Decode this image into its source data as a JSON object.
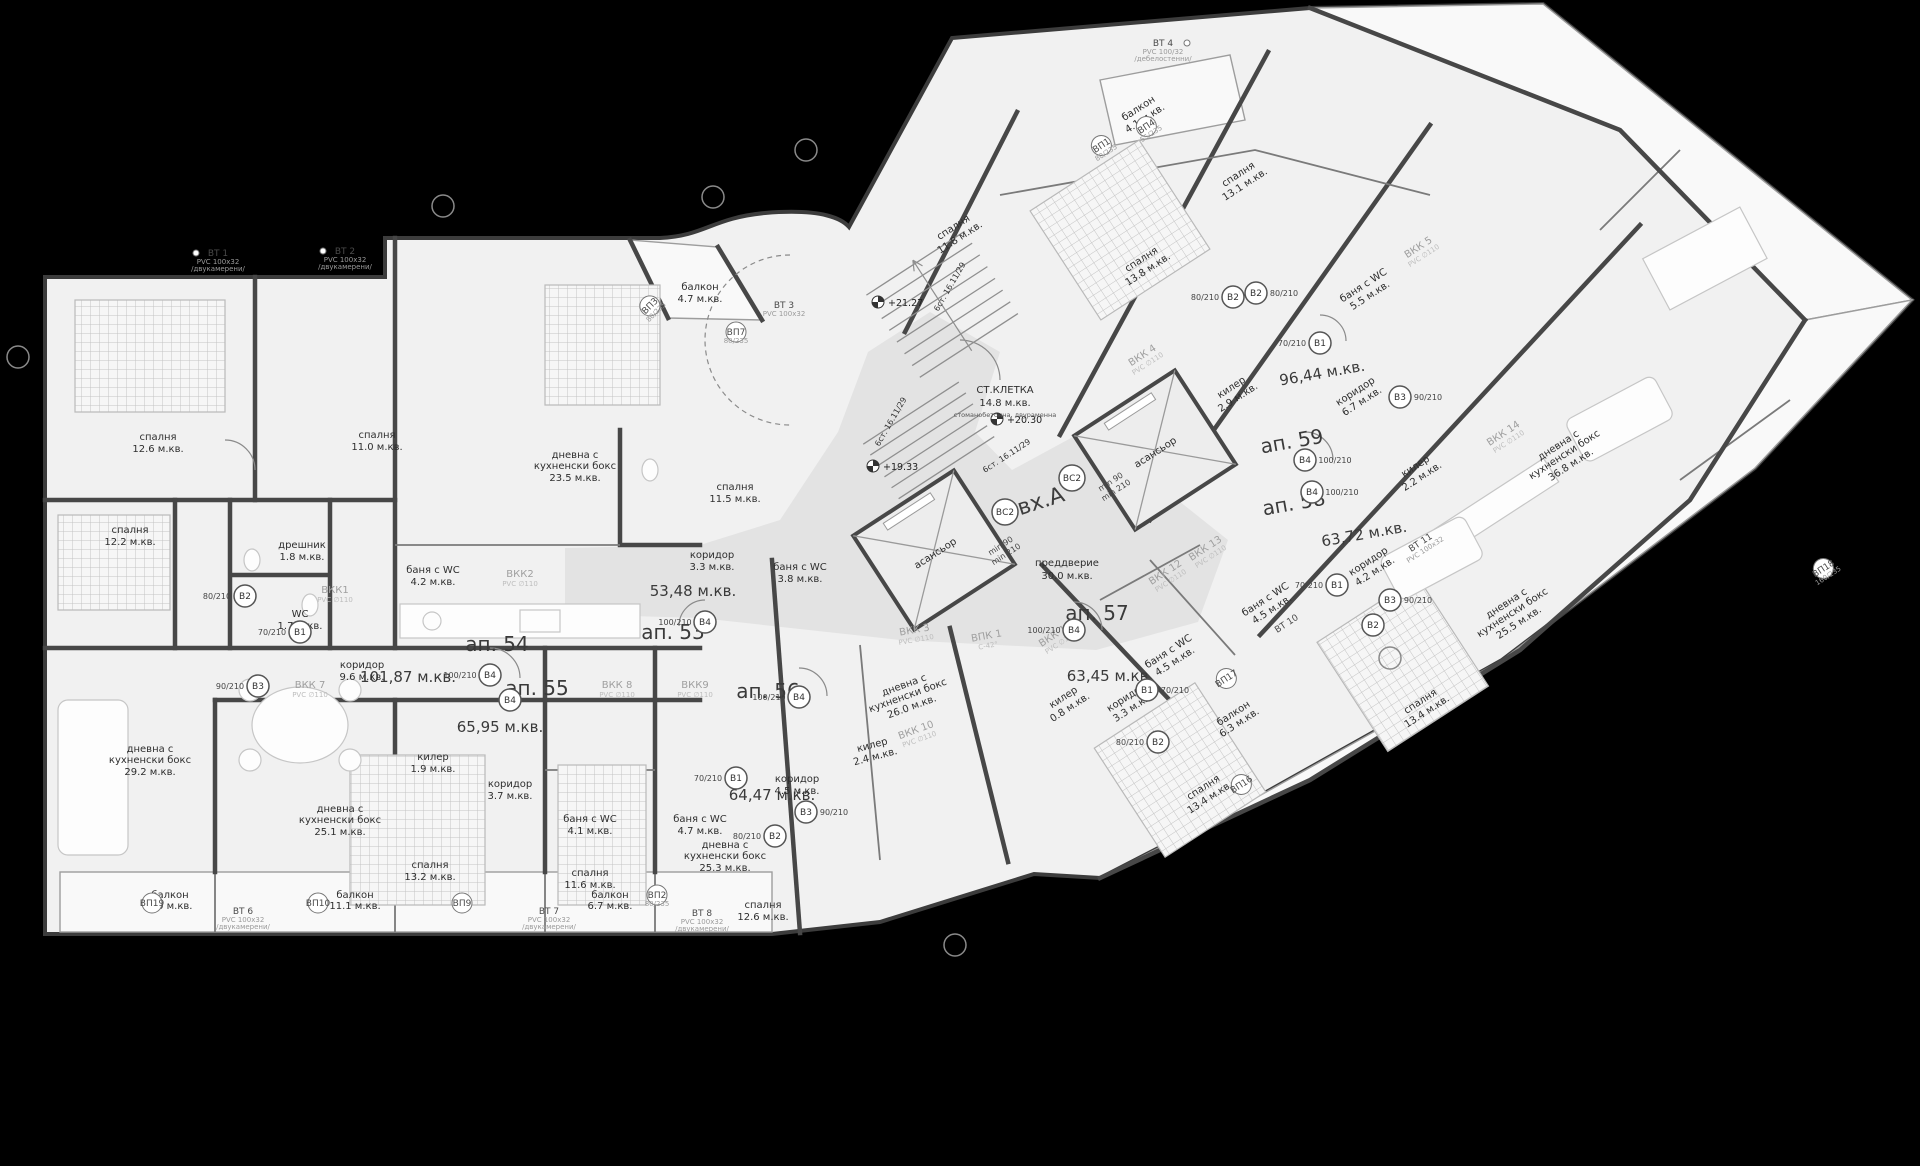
{
  "entrance": {
    "label": "вх.А"
  },
  "core": {
    "stair_name": "СТ.КЛЕТКА",
    "stair_area": "14.8 м.кв.",
    "stair_note": "стоманобетонна, двураменна",
    "flight_note": "6ст. 16.11/29",
    "elev1": "+21.27",
    "elev2": "+20.30",
    "elev3": "+19.33",
    "elevator": "асансьор",
    "vestibule_name": "преддверие",
    "vestibule_area": "30.0 м.кв.",
    "clearance1": "min 90",
    "clearance2": "min 210"
  },
  "apartments": [
    {
      "id": "ап. 53",
      "area": "53,48 м.кв."
    },
    {
      "id": "ап. 54",
      "area": "101,87 м.кв."
    },
    {
      "id": "ап. 55",
      "area": "65,95 м.кв."
    },
    {
      "id": "ап. 56",
      "area": "64,47 м.кв."
    },
    {
      "id": "ап. 57",
      "area": "63,45 м.кв."
    },
    {
      "id": "ап. 58",
      "area": "63,72 м.кв."
    },
    {
      "id": "ап. 59",
      "area": "96,44 м.кв."
    }
  ],
  "rooms": [
    {
      "l1": "спалня",
      "a": "12.6 м.кв."
    },
    {
      "l1": "спалня",
      "a": "11.0 м.кв."
    },
    {
      "l1": "спалня",
      "a": "12.2 м.кв."
    },
    {
      "l1": "дрешник",
      "a": "1.8 м.кв."
    },
    {
      "l1": "WC",
      "a": "1.7 м.кв."
    },
    {
      "l1": "баня с WC",
      "a": "4.2 м.кв."
    },
    {
      "l1": "дневна с",
      "l2": "кухненски бокс",
      "a": "23.5 м.кв."
    },
    {
      "l1": "спалня",
      "a": "11.5 м.кв."
    },
    {
      "l1": "коридор",
      "a": "3.3 м.кв."
    },
    {
      "l1": "баня с WC",
      "a": "3.8 м.кв."
    },
    {
      "l1": "балкон",
      "a": "4.7 м.кв."
    },
    {
      "l1": "коридор",
      "a": "9.6 м.кв."
    },
    {
      "l1": "дневна с",
      "l2": "кухненски бокс",
      "a": "29.2 м.кв."
    },
    {
      "l1": "килер",
      "a": "1.9 м.кв."
    },
    {
      "l1": "коридор",
      "a": "3.7 м.кв."
    },
    {
      "l1": "дневна с",
      "l2": "кухненски бокс",
      "a": "25.1 м.кв."
    },
    {
      "l1": "баня с WC",
      "a": "4.1 м.кв."
    },
    {
      "l1": "спалня",
      "a": "13.2 м.кв."
    },
    {
      "l1": "баня с WC",
      "a": "4.7 м.кв."
    },
    {
      "l1": "коридор",
      "a": "4.5 м.кв."
    },
    {
      "l1": "спалня",
      "a": "11.6 м.кв."
    },
    {
      "l1": "спалня",
      "a": "12.6 м.кв."
    },
    {
      "l1": "дневна с",
      "l2": "кухненски бокс",
      "a": "25.3 м.кв."
    },
    {
      "l1": "килер",
      "a": "2.4 м.кв."
    },
    {
      "l1": "дневна с",
      "l2": "кухненски бокс",
      "a": "26.0 м.кв."
    },
    {
      "l1": "спалня",
      "a": "11.8 м.кв."
    },
    {
      "l1": "спалня",
      "a": "13.8 м.кв."
    },
    {
      "l1": "спалня",
      "a": "13.1 м.кв."
    },
    {
      "l1": "баня с WC",
      "a": "5.5 м.кв."
    },
    {
      "l1": "килер",
      "a": "2.9 м.кв."
    },
    {
      "l1": "коридор",
      "a": "6.7 м.кв."
    },
    {
      "l1": "балкон",
      "a": "4.1 м.кв."
    },
    {
      "l1": "дневна с",
      "l2": "кухненски бокс",
      "a": "36.8 м.кв."
    },
    {
      "l1": "коридор",
      "a": "4.2 м.кв."
    },
    {
      "l1": "килер",
      "a": "2.2 м.кв."
    },
    {
      "l1": "дневна с",
      "l2": "кухненски бокс",
      "a": "25.5 м.кв."
    },
    {
      "l1": "спалня",
      "a": "13.4 м.кв."
    },
    {
      "l1": "баня с WC",
      "a": "4.5 м.кв."
    },
    {
      "l1": "килер",
      "a": "0.8 м.кв."
    },
    {
      "l1": "коридор",
      "a": "3.3 м.кв."
    },
    {
      "l1": "баня с WC",
      "a": "4.5 м.кв."
    },
    {
      "l1": "спалня",
      "a": "13.4 м.кв."
    },
    {
      "l1": "балкон",
      "a": "7.0 м.кв."
    },
    {
      "l1": "балкон",
      "a": "11.1 м.кв."
    },
    {
      "l1": "балкон",
      "a": "6.7 м.кв."
    },
    {
      "l1": "балкон",
      "a": "6.3 м.кв."
    }
  ],
  "shafts": [
    {
      "id": "ВКК1",
      "spec": "PVC ∅110"
    },
    {
      "id": "ВКК2",
      "spec": "PVC ∅110"
    },
    {
      "id": "ВКК 3",
      "spec": "PVC ∅110"
    },
    {
      "id": "ВКК 4",
      "spec": "PVC ∅110"
    },
    {
      "id": "ВКК 5",
      "spec": "PVC ∅110"
    },
    {
      "id": "ВКК 7",
      "spec": "PVC ∅110"
    },
    {
      "id": "ВКК 8",
      "spec": "PVC ∅110"
    },
    {
      "id": "ВКК9",
      "spec": "PVC ∅110"
    },
    {
      "id": "ВКК 10",
      "spec": "PVC ∅110"
    },
    {
      "id": "ВКК 11",
      "spec": "PVC ∅110"
    },
    {
      "id": "ВКК 12",
      "spec": "PVC ∅110"
    },
    {
      "id": "ВКК 13",
      "spec": "PVC ∅110"
    },
    {
      "id": "ВКК 14",
      "spec": "PVC ∅110"
    },
    {
      "id": "ВПК 1",
      "spec": "С-42°"
    }
  ],
  "tags": [
    {
      "id": "ВТ 1",
      "spec": "PVC 100х32",
      "note": "/двукамерени/"
    },
    {
      "id": "ВТ 2",
      "spec": "PVC 100х32",
      "note": "/двукамерени/"
    },
    {
      "id": "ВТ 3",
      "spec": "PVC 100х32"
    },
    {
      "id": "ВТ 4",
      "spec": "PVC 100/32",
      "note": "/дебелостенни/"
    },
    {
      "id": "ВТ 6",
      "spec": "PVC 100х32",
      "note": "/двукамерени/"
    },
    {
      "id": "ВТ 7",
      "spec": "PVC 100х32",
      "note": "/двукамерени/"
    },
    {
      "id": "ВТ 8",
      "spec": "PVC 100х32",
      "note": "/двукамерени/"
    },
    {
      "id": "ВТ 10"
    },
    {
      "id": "ВТ 11",
      "spec": "PVC 100х32"
    },
    {
      "id": "ВП1",
      "spec": "80/235"
    },
    {
      "id": "ВП2",
      "spec": "80/235"
    },
    {
      "id": "ВП3",
      "spec": "80/235"
    },
    {
      "id": "ВП4",
      "spec": "55/235"
    },
    {
      "id": "ВП7",
      "spec": "80/235"
    },
    {
      "id": "ВП9"
    },
    {
      "id": "ВП10"
    },
    {
      "id": "ВП16"
    },
    {
      "id": "ВП17"
    },
    {
      "id": "ВП18",
      "spec": "160/235"
    },
    {
      "id": "ВП19"
    }
  ],
  "markers": [
    {
      "id": "В2",
      "size": "80/210"
    },
    {
      "id": "В1",
      "size": "70/210"
    },
    {
      "id": "В3",
      "size": "90/210"
    },
    {
      "id": "В4",
      "size": "100/210"
    },
    {
      "id": "В4",
      "size": "100/210"
    },
    {
      "id": "В4",
      "size": "100/210"
    },
    {
      "id": "В4",
      "size": "100/210"
    },
    {
      "id": "В1",
      "size": "70/210"
    },
    {
      "id": "В2",
      "size": "80/210"
    },
    {
      "id": "В3",
      "size": "90/210"
    },
    {
      "id": "В4",
      "size": "100/210"
    },
    {
      "id": "В4",
      "size": "100/210"
    },
    {
      "id": "В4",
      "size": "100/210"
    },
    {
      "id": "В1",
      "size": "70/210"
    },
    {
      "id": "В3",
      "size": "90/210"
    },
    {
      "id": "В2",
      "size": "80/210"
    },
    {
      "id": "В2",
      "size": "80/210"
    },
    {
      "id": "В1",
      "size": "70/210"
    },
    {
      "id": "В3",
      "size": "90/210"
    },
    {
      "id": "В2",
      "size": "80/210"
    },
    {
      "id": "В2",
      "size": "80/210"
    },
    {
      "id": "В1",
      "size": "70/210"
    },
    {
      "id": "ВС2",
      "size": "100/230"
    },
    {
      "id": "ВС2",
      "size": "100/230"
    }
  ]
}
